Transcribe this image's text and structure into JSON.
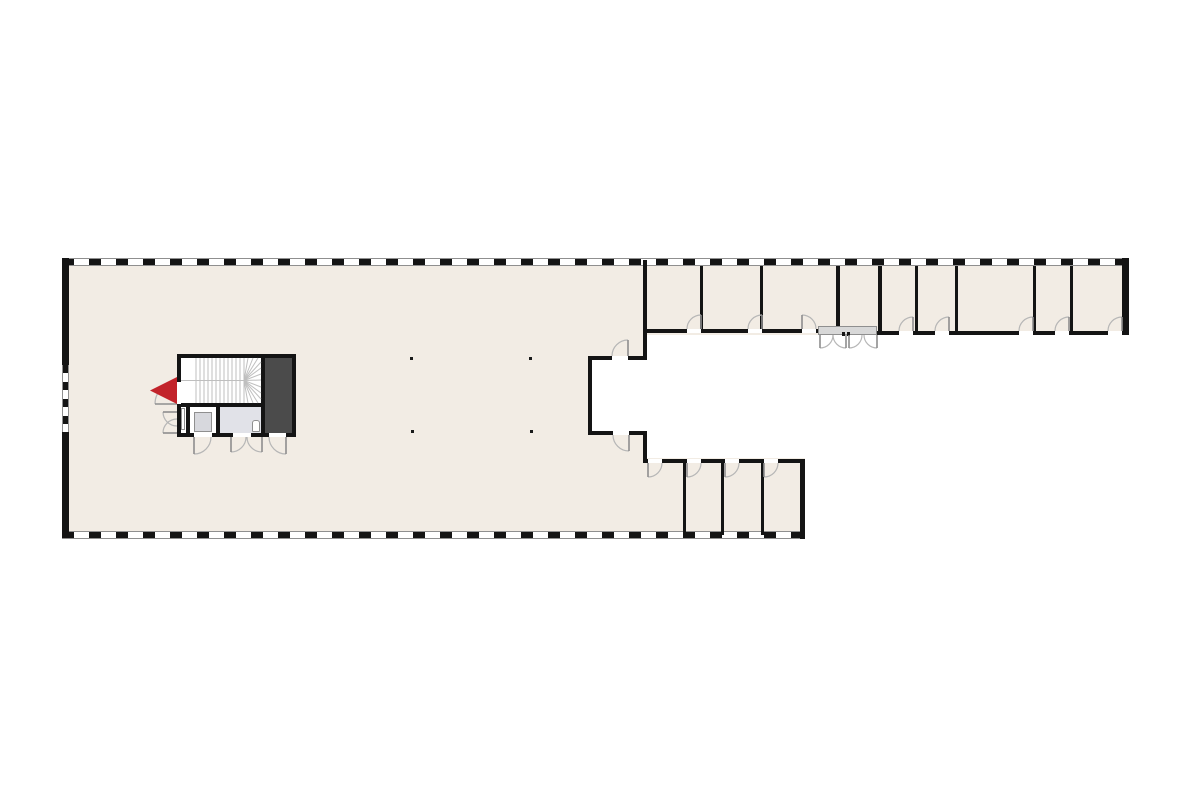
{
  "palette": {
    "bg": "#ffffff",
    "floor": "#f2ece4",
    "wall": "#141414",
    "shaft": "#4b4b4b",
    "wet": "#e1e2e8",
    "cabinet": "#d7d8dd",
    "canopy": "#d8d8d8",
    "frame": "#8f8f8f",
    "arc": "#b6b6b6",
    "leaf": "#8e8e8e",
    "column": "#1a1a1a",
    "stair_line": "#bfbfbf",
    "marker_red": "#c2232a"
  },
  "plan": {
    "width": 1200,
    "height": 800
  },
  "floors": [
    {
      "name": "hall-floor",
      "x": 62,
      "y": 258,
      "w": 583,
      "h": 280
    },
    {
      "name": "top-wing-floor",
      "x": 645,
      "y": 258,
      "w": 483,
      "h": 77
    },
    {
      "name": "bottom-wing-floor",
      "x": 645,
      "y": 458,
      "w": 160,
      "h": 80
    },
    {
      "name": "notch-courtyard",
      "x": 590,
      "y": 358,
      "w": 57,
      "h": 75,
      "fill": "bg"
    },
    {
      "name": "core-floor",
      "x": 179,
      "y": 356,
      "w": 115,
      "h": 79,
      "fill": "bg"
    },
    {
      "name": "wet-room-floor",
      "x": 220,
      "y": 407,
      "w": 41,
      "h": 26,
      "fill": "wet"
    },
    {
      "name": "shaft-fill",
      "x": 265,
      "y": 358,
      "w": 27,
      "h": 75,
      "fill": "shaft"
    }
  ],
  "stripe_walls": [
    {
      "name": "top-facade-window-wall",
      "x": 62,
      "y": 258,
      "w": 1066,
      "h": 8,
      "dir": "h"
    },
    {
      "name": "bottom-facade-window-wall",
      "x": 62,
      "y": 531,
      "w": 743,
      "h": 8,
      "dir": "h"
    },
    {
      "name": "left-facade-window-band",
      "x": 62,
      "y": 365,
      "w": 7,
      "h": 67,
      "dir": "v"
    }
  ],
  "walls": [
    {
      "name": "left-wall-upper",
      "x": 62,
      "y": 258,
      "w": 7,
      "h": 107
    },
    {
      "name": "left-wall-lower",
      "x": 62,
      "y": 432,
      "w": 7,
      "h": 106
    },
    {
      "name": "right-wall",
      "x": 1122,
      "y": 258,
      "w": 7,
      "h": 77
    },
    {
      "name": "hall-right-wall",
      "x": 643,
      "y": 260,
      "w": 4,
      "h": 100
    },
    {
      "name": "notch-top-wall",
      "x": 588,
      "y": 356,
      "w": 59,
      "h": 4
    },
    {
      "name": "notch-left-wall",
      "x": 588,
      "y": 356,
      "w": 4,
      "h": 79
    },
    {
      "name": "notch-bottom-wall",
      "x": 588,
      "y": 431,
      "w": 59,
      "h": 4
    },
    {
      "name": "hall-right-wall-lower",
      "x": 643,
      "y": 431,
      "w": 4,
      "h": 32
    },
    {
      "name": "top-wing-bottom-wall-west",
      "x": 645,
      "y": 329,
      "w": 173,
      "h": 4
    },
    {
      "name": "top-wing-bottom-wall-east",
      "x": 877,
      "y": 331,
      "w": 247,
      "h": 4
    },
    {
      "name": "top-wing-partition-1",
      "x": 700,
      "y": 266,
      "w": 3,
      "h": 67
    },
    {
      "name": "top-wing-partition-2",
      "x": 760,
      "y": 266,
      "w": 3,
      "h": 67
    },
    {
      "name": "top-wing-partition-3",
      "x": 836,
      "y": 266,
      "w": 4,
      "h": 64
    },
    {
      "name": "top-wing-partition-4",
      "x": 878,
      "y": 266,
      "w": 4,
      "h": 69
    },
    {
      "name": "top-wing-partition-5",
      "x": 915,
      "y": 266,
      "w": 3,
      "h": 69
    },
    {
      "name": "top-wing-partition-6",
      "x": 955,
      "y": 266,
      "w": 3,
      "h": 69
    },
    {
      "name": "top-wing-partition-7",
      "x": 1033,
      "y": 266,
      "w": 3,
      "h": 69
    },
    {
      "name": "top-wing-partition-8",
      "x": 1070,
      "y": 266,
      "w": 3,
      "h": 69
    },
    {
      "name": "bottom-wing-top-wall",
      "x": 643,
      "y": 459,
      "w": 162,
      "h": 4
    },
    {
      "name": "bottom-wing-partition-1",
      "x": 683,
      "y": 461,
      "w": 3,
      "h": 74
    },
    {
      "name": "bottom-wing-partition-2",
      "x": 721,
      "y": 461,
      "w": 3,
      "h": 74
    },
    {
      "name": "bottom-wing-partition-3",
      "x": 761,
      "y": 461,
      "w": 3,
      "h": 74
    },
    {
      "name": "bottom-wing-right-wall",
      "x": 800,
      "y": 459,
      "w": 5,
      "h": 80
    },
    {
      "name": "core-top-wall",
      "x": 177,
      "y": 354,
      "w": 119,
      "h": 4
    },
    {
      "name": "core-bottom-wall",
      "x": 177,
      "y": 433,
      "w": 119,
      "h": 4
    },
    {
      "name": "core-left-wall",
      "x": 177,
      "y": 354,
      "w": 4,
      "h": 83
    },
    {
      "name": "core-right-wall",
      "x": 292,
      "y": 354,
      "w": 4,
      "h": 83
    },
    {
      "name": "core-mid-wall",
      "x": 177,
      "y": 403,
      "w": 88,
      "h": 4
    },
    {
      "name": "core-room-partition-1",
      "x": 186,
      "y": 403,
      "w": 4,
      "h": 34
    },
    {
      "name": "core-room-partition-2",
      "x": 216,
      "y": 403,
      "w": 4,
      "h": 34
    },
    {
      "name": "core-shaft-wall",
      "x": 261,
      "y": 354,
      "w": 4,
      "h": 83
    }
  ],
  "door_gaps": [
    {
      "name": "gap-top-room-1",
      "x": 687,
      "y": 329,
      "w": 14,
      "h": 4
    },
    {
      "name": "gap-top-room-2",
      "x": 748,
      "y": 329,
      "w": 14,
      "h": 4
    },
    {
      "name": "gap-top-room-3",
      "x": 802,
      "y": 329,
      "w": 14,
      "h": 4
    },
    {
      "name": "gap-top-room-4",
      "x": 899,
      "y": 331,
      "w": 14,
      "h": 4
    },
    {
      "name": "gap-top-room-5",
      "x": 935,
      "y": 331,
      "w": 14,
      "h": 4
    },
    {
      "name": "gap-top-room-6",
      "x": 1019,
      "y": 331,
      "w": 14,
      "h": 4
    },
    {
      "name": "gap-top-room-7",
      "x": 1055,
      "y": 331,
      "w": 14,
      "h": 4
    },
    {
      "name": "gap-top-room-8",
      "x": 1108,
      "y": 331,
      "w": 14,
      "h": 4
    },
    {
      "name": "gap-notch-top-door",
      "x": 612,
      "y": 356,
      "w": 16,
      "h": 4
    },
    {
      "name": "gap-notch-bottom-door",
      "x": 613,
      "y": 431,
      "w": 16,
      "h": 4
    },
    {
      "name": "gap-bottom-room-1",
      "x": 648,
      "y": 459,
      "w": 14,
      "h": 4
    },
    {
      "name": "gap-bottom-room-2",
      "x": 687,
      "y": 459,
      "w": 14,
      "h": 4
    },
    {
      "name": "gap-bottom-room-3",
      "x": 725,
      "y": 459,
      "w": 14,
      "h": 4
    },
    {
      "name": "gap-bottom-room-4",
      "x": 764,
      "y": 459,
      "w": 14,
      "h": 4
    },
    {
      "name": "gap-core-entry",
      "x": 177,
      "y": 382,
      "w": 4,
      "h": 22
    },
    {
      "name": "gap-core-room-1",
      "x": 194,
      "y": 433,
      "w": 18,
      "h": 4
    },
    {
      "name": "gap-core-room-2",
      "x": 233,
      "y": 433,
      "w": 18,
      "h": 4
    },
    {
      "name": "gap-core-shaft",
      "x": 269,
      "y": 433,
      "w": 17,
      "h": 4
    }
  ],
  "fixtures": [
    {
      "name": "duct-fixture",
      "x": 181,
      "y": 408,
      "w": 4,
      "h": 22,
      "fill": "bg",
      "stroke": "frame"
    },
    {
      "name": "cabinet-fixture",
      "x": 194,
      "y": 412,
      "w": 18,
      "h": 20,
      "fill": "cabinet",
      "stroke": "frame"
    },
    {
      "name": "toilet-fixture",
      "x": 252,
      "y": 420,
      "w": 8,
      "h": 12,
      "fill": "bg",
      "stroke": "frame"
    },
    {
      "name": "entrance-canopy",
      "x": 818,
      "y": 326,
      "w": 59,
      "h": 9,
      "fill": "canopy",
      "stroke": "frame"
    },
    {
      "name": "door-post-1",
      "x": 842,
      "y": 332,
      "w": 3,
      "h": 4,
      "fill": "wall"
    },
    {
      "name": "door-post-2",
      "x": 847,
      "y": 332,
      "w": 3,
      "h": 4,
      "fill": "wall"
    }
  ],
  "columns": [
    {
      "name": "column-1",
      "x": 410,
      "y": 357
    },
    {
      "name": "column-2",
      "x": 529,
      "y": 357
    },
    {
      "name": "column-3",
      "x": 411,
      "y": 430
    },
    {
      "name": "column-4",
      "x": 530,
      "y": 430
    }
  ],
  "column_size": 3,
  "doors": [
    {
      "name": "door-top-room-1",
      "x": 687,
      "y": 315,
      "r": 14,
      "hinge": "br"
    },
    {
      "name": "door-top-room-2",
      "x": 748,
      "y": 315,
      "r": 14,
      "hinge": "br"
    },
    {
      "name": "door-top-room-3",
      "x": 802,
      "y": 315,
      "r": 14,
      "hinge": "bl"
    },
    {
      "name": "door-top-room-4",
      "x": 899,
      "y": 317,
      "r": 14,
      "hinge": "br"
    },
    {
      "name": "door-top-room-5",
      "x": 935,
      "y": 317,
      "r": 14,
      "hinge": "br"
    },
    {
      "name": "door-top-room-6",
      "x": 1019,
      "y": 317,
      "r": 14,
      "hinge": "br"
    },
    {
      "name": "door-top-room-7",
      "x": 1055,
      "y": 317,
      "r": 14,
      "hinge": "br"
    },
    {
      "name": "door-top-room-8",
      "x": 1108,
      "y": 317,
      "r": 14,
      "hinge": "br"
    },
    {
      "name": "door-notch-top",
      "x": 612,
      "y": 340,
      "r": 16,
      "hinge": "br"
    },
    {
      "name": "door-notch-bottom",
      "x": 613,
      "y": 435,
      "r": 16,
      "hinge": "tr"
    },
    {
      "name": "door-bottom-room-1",
      "x": 648,
      "y": 463,
      "r": 14,
      "hinge": "tl"
    },
    {
      "name": "door-bottom-room-2",
      "x": 687,
      "y": 463,
      "r": 14,
      "hinge": "tl"
    },
    {
      "name": "door-bottom-room-3",
      "x": 725,
      "y": 463,
      "r": 14,
      "hinge": "tl"
    },
    {
      "name": "door-bottom-room-4",
      "x": 764,
      "y": 463,
      "r": 14,
      "hinge": "tl"
    },
    {
      "name": "entrance-door-leaf-1",
      "x": 820,
      "y": 335,
      "r": 13,
      "hinge": "tl"
    },
    {
      "name": "entrance-door-leaf-2",
      "x": 833,
      "y": 335,
      "r": 13,
      "hinge": "tr"
    },
    {
      "name": "entrance-door-leaf-3",
      "x": 849,
      "y": 335,
      "r": 13,
      "hinge": "tl"
    },
    {
      "name": "entrance-door-leaf-4",
      "x": 864,
      "y": 335,
      "r": 13,
      "hinge": "tr"
    },
    {
      "name": "door-core-room-1",
      "x": 194,
      "y": 437,
      "r": 17,
      "hinge": "tl"
    },
    {
      "name": "door-core-room-2a",
      "x": 231,
      "y": 437,
      "r": 15,
      "hinge": "tl"
    },
    {
      "name": "door-core-room-2b",
      "x": 247,
      "y": 437,
      "r": 15,
      "hinge": "tr"
    },
    {
      "name": "door-core-shaft",
      "x": 269,
      "y": 437,
      "r": 17,
      "hinge": "tr"
    },
    {
      "name": "door-core-entry",
      "x": 155,
      "y": 382,
      "r": 22,
      "hinge": "br",
      "leaf": "h"
    },
    {
      "name": "door-core-strip-a",
      "x": 163,
      "y": 412,
      "r": 14,
      "hinge": "tr",
      "leaf": "h"
    },
    {
      "name": "door-core-strip-b",
      "x": 163,
      "y": 419,
      "r": 14,
      "hinge": "br",
      "leaf": "h"
    }
  ],
  "stair": {
    "name": "staircase",
    "x": 181,
    "y": 358,
    "w": 80,
    "h": 45,
    "tread_x0": 15,
    "tread_step": 4,
    "tread_count": 13,
    "mid_y": 22.5,
    "fan_center": [
      63,
      22.5
    ],
    "rays": [
      [
        67,
        0
      ],
      [
        72,
        0
      ],
      [
        77,
        0
      ],
      [
        80,
        4
      ],
      [
        80,
        10
      ],
      [
        80,
        16
      ],
      [
        80,
        22
      ],
      [
        80,
        29
      ],
      [
        80,
        35
      ],
      [
        80,
        41
      ],
      [
        77,
        45
      ],
      [
        72,
        45
      ],
      [
        67,
        45
      ]
    ]
  },
  "entry_marker": {
    "name": "entry-arrow",
    "x": 148,
    "y": 375,
    "w": 32,
    "h": 32,
    "points": "29,2 29,29 2,15.5"
  }
}
